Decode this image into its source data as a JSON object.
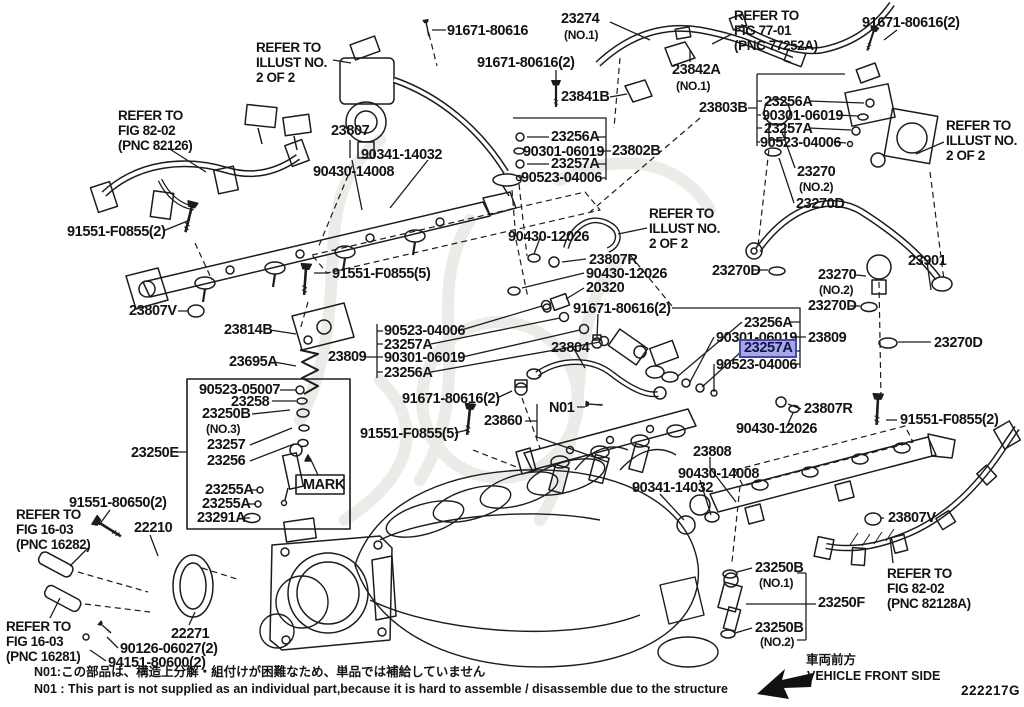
{
  "diagram": {
    "code": "222217G",
    "note_jp": "N01:この部品は、構造上分解・組付けが困難なため、単品では補給していません",
    "note_en": "N01 : This part is not supplied as an individual part,because it is hard to assemble / disassemble due to the structure",
    "direction_jp": "車両前方",
    "direction_en": "VEHICLE FRONT SIDE",
    "highlighted_part": "23257A",
    "highlight_bg": "#a7a7e6",
    "highlight_border": "#4646b0"
  },
  "refs": {
    "illust_top_left": "REFER TO\nILLUST NO.\n2 OF 2",
    "fig_77_01": "REFER TO\nFIG 77-01\n(PNC 77252A)",
    "illust_top_right": "REFER TO\nILLUST NO.\n2 OF 2",
    "fig_82_02_left": "REFER TO\nFIG 82-02\n(PNC 82126)",
    "illust_mid": "REFER TO\nILLUST NO.\n2 OF 2",
    "fig_16_03_upper": "REFER TO\nFIG 16-03\n(PNC 16282)",
    "fig_16_03_lower": "REFER TO\nFIG 16-03\n(PNC 16281)",
    "fig_82_02_right": "REFER TO\nFIG 82-02\n(PNC 82128A)"
  },
  "labels": {
    "p23274": "23274",
    "p23274_no": "(NO.1)",
    "p91671_t": "91671-80616",
    "p91671_tr": "91671-80616(2)",
    "p91671_c": "91671-80616(2)",
    "p23841B": "23841B",
    "p23842A": "23842A",
    "p23842A_no": "(NO.1)",
    "p23803B": "23803B",
    "p23256A_r1": "23256A",
    "p90301_r1": "90301-06019",
    "p23257A_r1": "23257A",
    "p90523_r1": "90523-04006",
    "p23807": "23807",
    "p90341_t": "90341-14032",
    "p90430_14008_t": "90430-14008",
    "p23256A_c1": "23256A",
    "p90301_c1": "90301-06019",
    "p23802B": "23802B",
    "p23257A_c1": "23257A",
    "p90523_c1": "90523-04006",
    "p23270_1": "23270",
    "p23270_1no": "(NO.2)",
    "p23270D_1": "23270D",
    "p91551F2_l": "91551-F0855(2)",
    "p90430_12026_t": "90430-12026",
    "p23901": "23901",
    "p23270_2": "23270",
    "p23270_2no": "(NO.2)",
    "p23270D_2": "23270D",
    "p91551F5_t": "91551-F0855(5)",
    "p23807R_1": "23807R",
    "p90430_12026_m": "90430-12026",
    "p20320": "20320",
    "p91671_m": "91671-80616(2)",
    "p23270D_3": "23270D",
    "p23270D_4": "23270D",
    "p23807V_l": "23807V",
    "p23814B": "23814B",
    "p90523_c2": "90523-04006",
    "p23257A_c2": "23257A",
    "p90301_c2": "90301-06019",
    "p23256A_c2": "23256A",
    "p23809_l": "23809",
    "p23695A": "23695A",
    "p23804": "23804",
    "p23256A_r2": "23256A",
    "p90301_r2": "90301-06019",
    "p23257A_hl": "23257A",
    "p90523_r2": "90523-04006",
    "p23809_r": "23809",
    "p91671_b": "91671-80616(2)",
    "pN01": "N01",
    "p23860": "23860",
    "p91551F5_b": "91551-F0855(5)",
    "p23807R_2": "23807R",
    "p90430_12026_b": "90430-12026",
    "p91551F2_r": "91551-F0855(2)",
    "p90523_05007": "90523-05007",
    "p23258": "23258",
    "p23250B_3": "23250B",
    "p23250B_3no": "(NO.3)",
    "p23257": "23257",
    "p23256": "23256",
    "p23250E": "23250E",
    "p23255A_1": "23255A",
    "p23255A_2": "23255A",
    "p23291A": "23291A",
    "pMARK": "MARK",
    "p23808": "23808",
    "p90430_14008_b": "90430-14008",
    "p90341_b": "90341-14032",
    "p23807V_r": "23807V",
    "p91551_80650": "91551-80650(2)",
    "p22210": "22210",
    "p22271": "22271",
    "p90126": "90126-06027(2)",
    "p94151": "94151-80600(2)",
    "p23250B_1": "23250B",
    "p23250B_1no": "(NO.1)",
    "p23250F": "23250F",
    "p23250B_2": "23250B",
    "p23250B_2no": "(NO.2)"
  }
}
